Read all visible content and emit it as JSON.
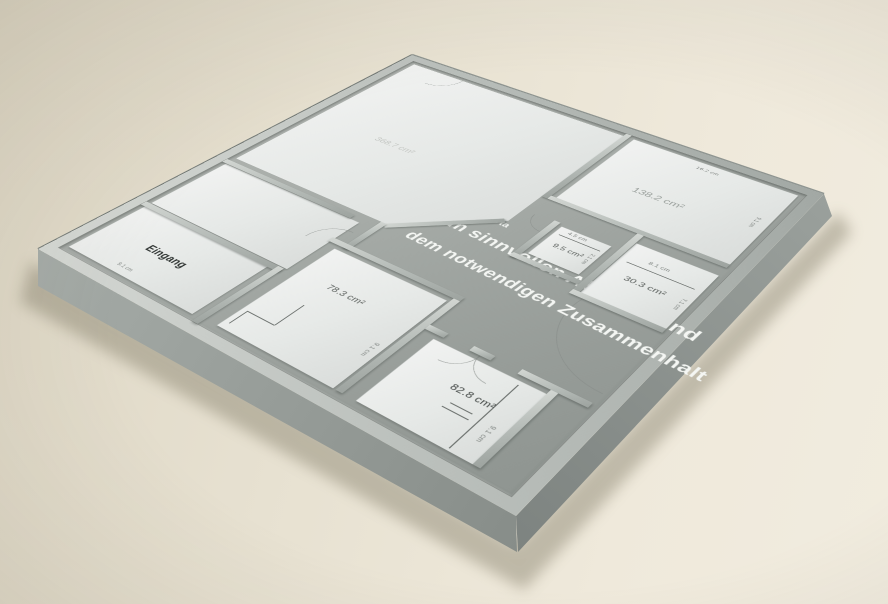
{
  "box_model": {
    "author": "Yasutomo Ota",
    "title_line_1": "Vom sinnvollen Abstand und",
    "title_line_2": "dem notwendigen Zusammenhalt",
    "rooms": {
      "entrance": "Eingang",
      "big_room_area": "368.7 cm²",
      "top_right_room_area": "138.2 cm²",
      "small_room_area": "9.5 cm²",
      "right_room_area": "30.3 cm²",
      "center_room_area": "78.3 cm²",
      "bottom_room_area": "82.8 cm²"
    },
    "dimensions": {
      "dim_4_5": "4.5 cm",
      "dim_8_1": "8.1 cm",
      "dim_16_2": "16.2 cm",
      "dim_2_1": "2.1 cm",
      "dim_7_1": "7.1 cm",
      "dim_9_1": "9.1 cm"
    },
    "colors": {
      "background_beige": "#e8e1d1",
      "box_gray": "#a9aeaa",
      "card_white": "#e9ebe9",
      "title_white": "#f4f6f3"
    }
  }
}
